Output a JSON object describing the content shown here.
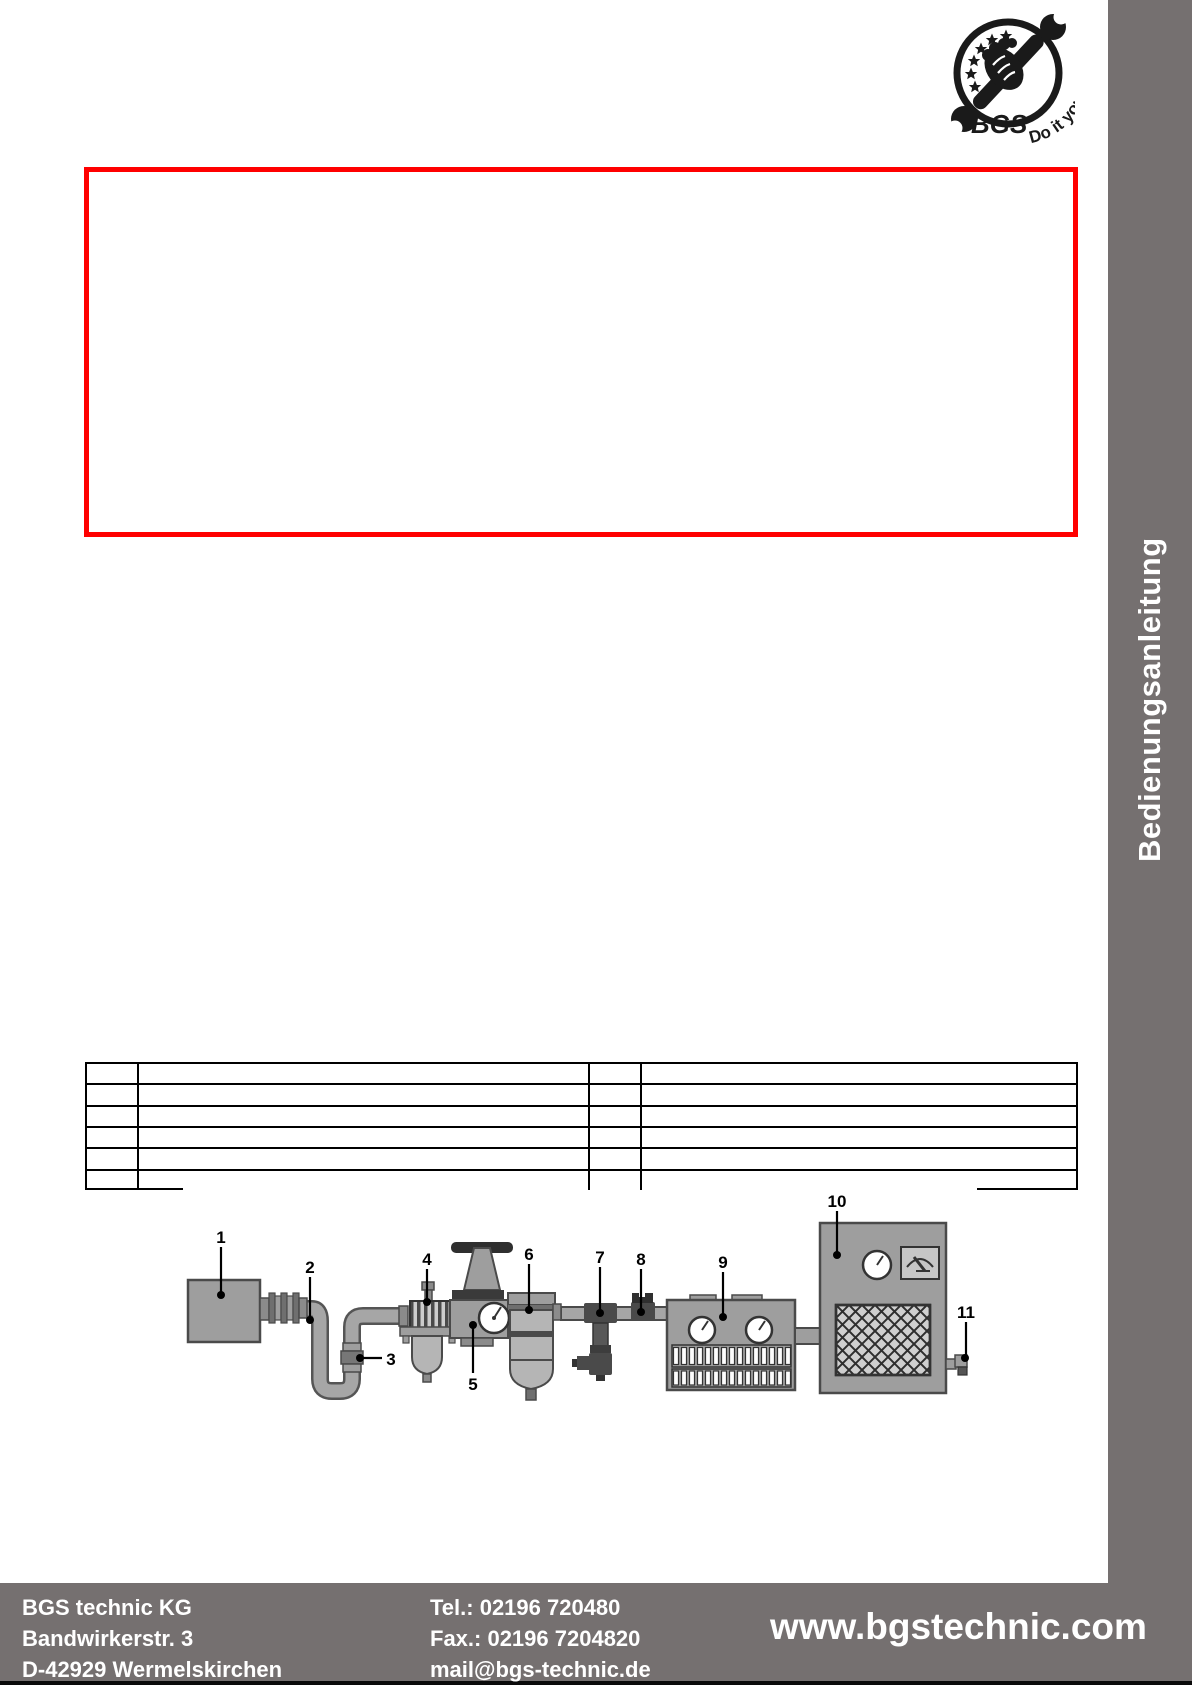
{
  "logo": {
    "brand": "BGS",
    "tagline": "Do it yourself"
  },
  "sidebar": {
    "label": "Bedienungsanleitung"
  },
  "colors": {
    "accent_red": "#ff0000",
    "band_gray": "#757070",
    "diagram_gray": "#9e9e9e"
  },
  "spec_table": {
    "rows": 6,
    "columns": 4,
    "cells_empty": true
  },
  "diagram": {
    "labels": [
      "1",
      "2",
      "3",
      "4",
      "5",
      "6",
      "7",
      "8",
      "9",
      "10",
      "11"
    ]
  },
  "footer": {
    "company": "BGS technic KG",
    "address_line1": "Bandwirkerstr. 3",
    "address_line2": "D-42929 Wermelskirchen",
    "phone": "Tel.: 02196 720480",
    "fax": "Fax.: 02196 7204820",
    "email": "mail@bgs-technic.de",
    "website": "www.bgstechnic.com"
  }
}
